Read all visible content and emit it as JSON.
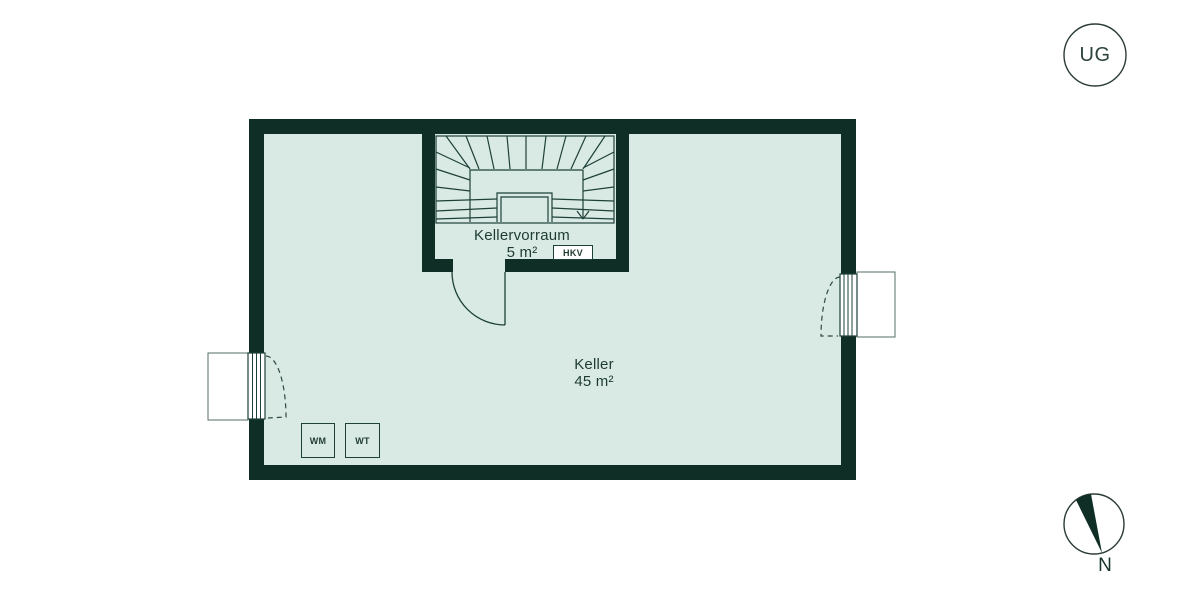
{
  "floor_badge": {
    "label": "UG"
  },
  "rooms": {
    "kellervorraum": {
      "name": "Kellervorraum",
      "area": "5 m²"
    },
    "keller": {
      "name": "Keller",
      "area": "45 m²"
    }
  },
  "fixtures": {
    "heating_distributor": "HKV",
    "washing_machine": "WM",
    "dryer": "WT"
  },
  "compass": {
    "north_label": "N"
  },
  "colors": {
    "wall": "#0f2f26",
    "floor": "#d9eae4",
    "line": "#1d4038",
    "background": "#ffffff"
  }
}
